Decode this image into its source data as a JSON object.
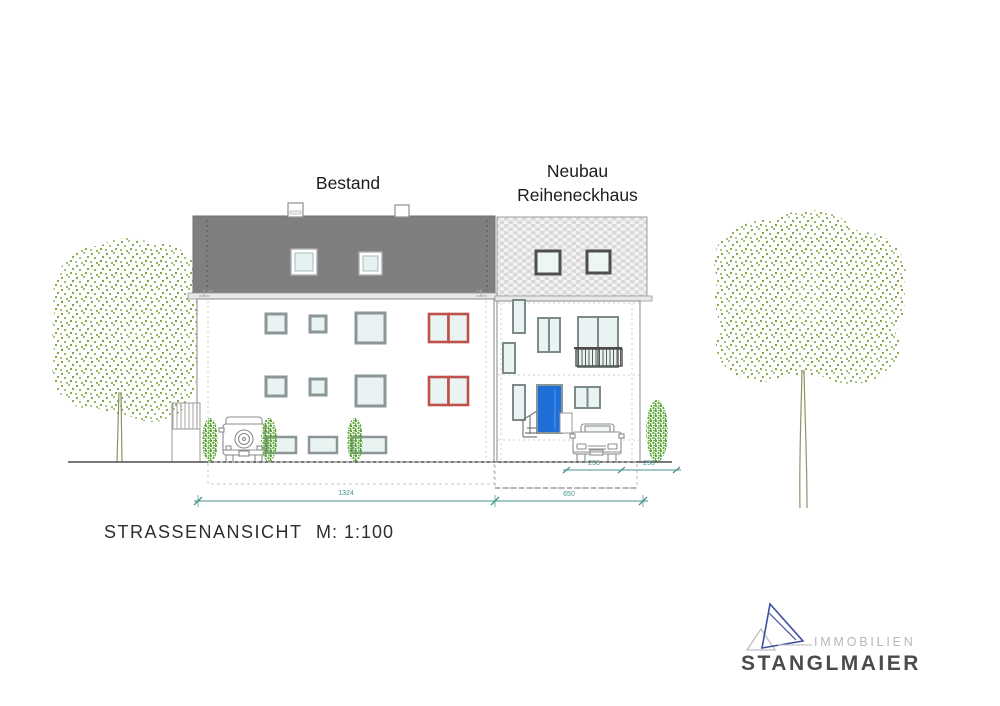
{
  "labels": {
    "bestand": "Bestand",
    "neubau_line1": "Neubau",
    "neubau_line2": "Reiheneckhaus"
  },
  "title": {
    "text": "STRASSENANSICHT",
    "scale": "M: 1:100"
  },
  "dims": {
    "total_bestand": "1324",
    "total_neubau": "650",
    "parking1": "250",
    "parking2": "250"
  },
  "logo": {
    "line1": "IMMOBILIEN",
    "line2": "STANGLMAIER"
  },
  "colors": {
    "roof_dark": "#7f7f7f",
    "shingle_gray": "#d9d9d9",
    "window_frame": "#8a9697",
    "window_pane": "#e9f3f2",
    "accent_red_window": "#c0504a",
    "door_blue": "#1f6fd8",
    "dimension_teal": "#47918c",
    "tree_green": "#7ca43e",
    "bush_green": "#57a33b",
    "logo_blue": "#3d4fa1",
    "logo_gray": "#b7b8ba",
    "logo_dark": "#4a4b4d"
  }
}
